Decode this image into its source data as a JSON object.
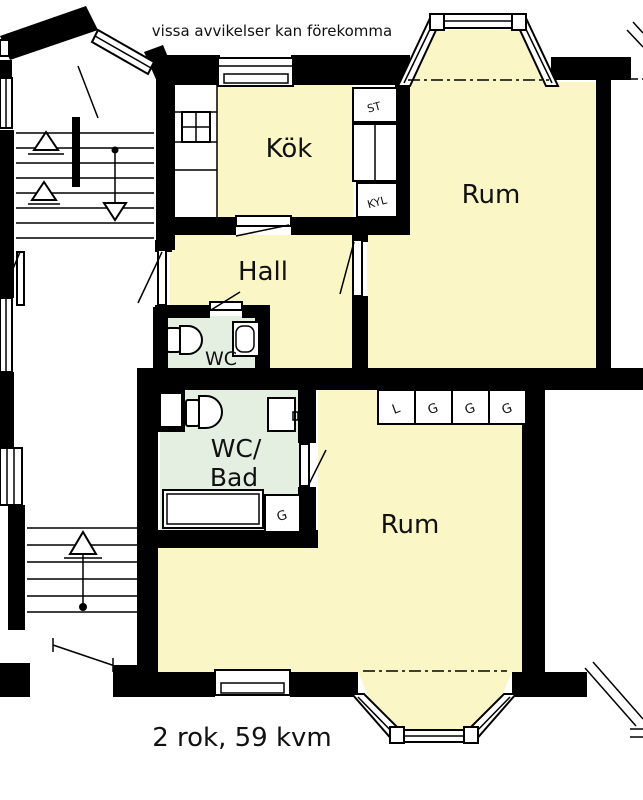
{
  "labels": {
    "disclaimer": "vissa avvikelser kan förekomma",
    "kitchen": "Kök",
    "room_upper": "Rum",
    "hall": "Hall",
    "wc": "WC",
    "wc_bath_line1": "WC/",
    "wc_bath_line2": "Bad",
    "room_lower": "Rum",
    "footer": "2 rok, 59 kvm",
    "closet_st": "ST",
    "closet_fridge": "KYL",
    "wardrobes": [
      "L",
      "G",
      "G",
      "G"
    ],
    "closet_g": "G"
  },
  "colors": {
    "floor": "#faf6c6",
    "wet_floor": "#e4efe2",
    "wall": "#000000",
    "background": "#ffffff",
    "text": "#111111"
  }
}
